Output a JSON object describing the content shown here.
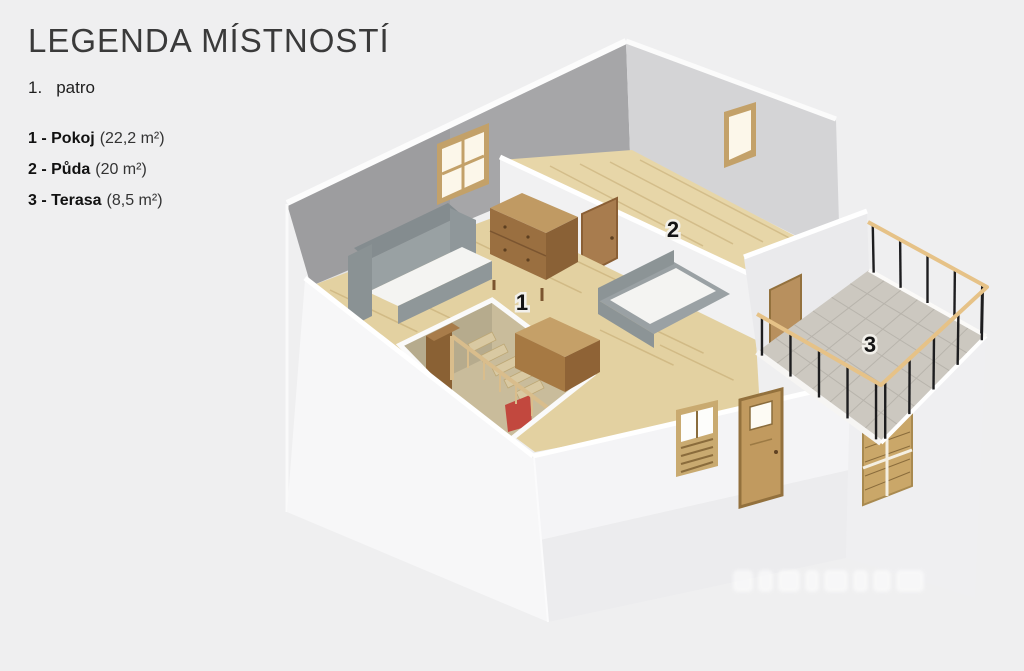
{
  "legend": {
    "title": "LEGENDA MÍSTNOSTÍ",
    "floor_number": "1.",
    "floor_name": "patro",
    "items": [
      {
        "label": "1 - Pokoj",
        "area": "(22,2 m²)"
      },
      {
        "label": "2 - Půda",
        "area": "(20 m²)"
      },
      {
        "label": "3 - Terasa",
        "area": "(8,5 m²)"
      }
    ]
  },
  "plan": {
    "room_labels": [
      {
        "number": "1"
      },
      {
        "number": "2"
      },
      {
        "number": "3"
      }
    ],
    "colors": {
      "background": "#efeff0",
      "wall_dark": "#a6a6a8",
      "wall_mid": "#d4d4d6",
      "wall_partition": "#f1f1f2",
      "wall_exterior_left": "#f7f7f8",
      "wall_exterior_front": "#ececee",
      "wall_exterior_right": "#efeff1",
      "wall_terrace": "#eaeaec",
      "wood_floor": "#e3d1a1",
      "wood_floor2": "#e7d6a8",
      "plank_line": "#c2ab77",
      "tile": "#ccc8c0",
      "tile_line": "#b8b4ac",
      "rail_wood": "#e6c287",
      "rail_post": "#1d1d1f",
      "door_wood": "#c19a5f",
      "door_frame": "#93713d",
      "sofa_gray": "#8d9496",
      "mattress": "#f4f4f2",
      "dresser_top": "#c09a63",
      "dresser_front": "#9a6f40",
      "window_frame": "#c3a169",
      "window_pane": "#fcf7ea",
      "stair_pit": "#c9bc9b",
      "chair_red": "#c2483e"
    }
  }
}
